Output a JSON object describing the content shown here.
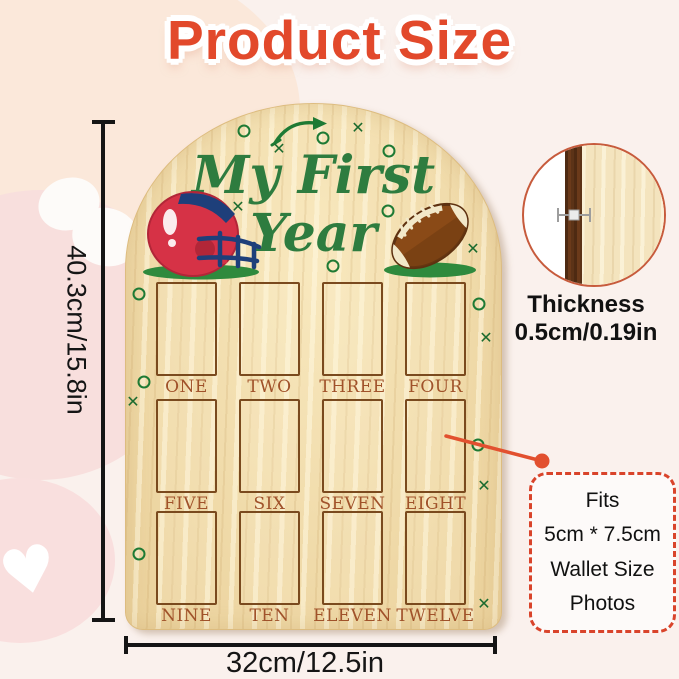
{
  "title": "Product Size",
  "board": {
    "heading_line1": "My First",
    "heading_line2": "Year",
    "slot_labels": [
      "ONE",
      "TWO",
      "THREE",
      "FOUR",
      "FIVE",
      "SIX",
      "SEVEN",
      "EIGHT",
      "NINE",
      "TEN",
      "ELEVEN",
      "TWELVE"
    ],
    "marks": [
      {
        "type": "o",
        "x": 118,
        "y": 27
      },
      {
        "type": "x",
        "x": 153,
        "y": 45
      },
      {
        "type": "o",
        "x": 197,
        "y": 34
      },
      {
        "type": "x",
        "x": 232,
        "y": 24
      },
      {
        "type": "o",
        "x": 263,
        "y": 47
      },
      {
        "type": "x",
        "x": 112,
        "y": 103
      },
      {
        "type": "o",
        "x": 262,
        "y": 107
      },
      {
        "type": "x",
        "x": 347,
        "y": 145
      },
      {
        "type": "o",
        "x": 207,
        "y": 162
      },
      {
        "type": "o",
        "x": 13,
        "y": 190
      },
      {
        "type": "o",
        "x": 353,
        "y": 200
      },
      {
        "type": "x",
        "x": 360,
        "y": 234
      },
      {
        "type": "o",
        "x": 18,
        "y": 278
      },
      {
        "type": "x",
        "x": 7,
        "y": 298
      },
      {
        "type": "o",
        "x": 352,
        "y": 341
      },
      {
        "type": "x",
        "x": 358,
        "y": 382
      },
      {
        "type": "o",
        "x": 13,
        "y": 450
      },
      {
        "type": "x",
        "x": 358,
        "y": 500
      }
    ],
    "icons": {
      "helmet": "football-helmet-icon",
      "football": "american-football-icon",
      "arrow": "play-route-arrow-icon"
    }
  },
  "dimensions": {
    "height_label": "40.3cm/15.8in",
    "width_label": "32cm/12.5in"
  },
  "thickness": {
    "label": "Thickness",
    "value": "0.5cm/0.19in"
  },
  "fits_note": {
    "line1": "Fits",
    "line2": "5cm * 7.5cm",
    "line3": "Wallet Size",
    "line4": "Photos"
  },
  "decor": {
    "heart_glyph": "♥"
  },
  "colors": {
    "accent_red": "#E2492B",
    "board_green": "#2E7C3F",
    "label_brown": "#A0522A",
    "wood": "#F2DDAB",
    "callout_red": "#D9442B",
    "helmet_red": "#D63246",
    "facemask_navy": "#1E3F7A",
    "football_brown": "#8A4A17",
    "grass_green": "#2F8A3D"
  }
}
